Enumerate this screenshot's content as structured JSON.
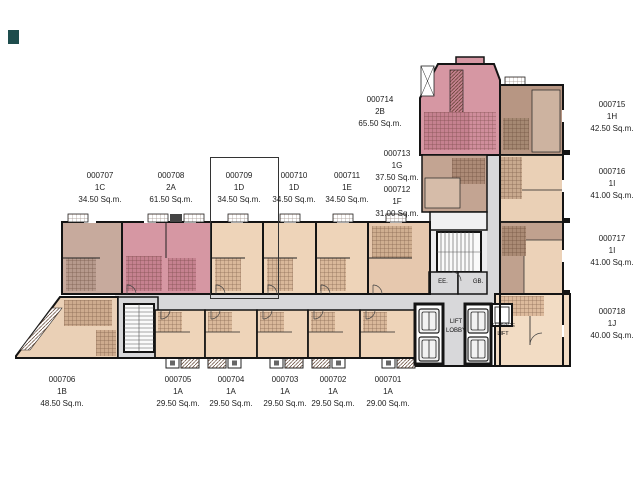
{
  "selection": {
    "selected_unit": "000709"
  },
  "units": [
    {
      "number": "000707",
      "type": "1C",
      "area": "34.50 Sq.m."
    },
    {
      "number": "000708",
      "type": "2A",
      "area": "61.50 Sq.m."
    },
    {
      "number": "000709",
      "type": "1D",
      "area": "34.50 Sq.m."
    },
    {
      "number": "000710",
      "type": "1D",
      "area": "34.50 Sq.m."
    },
    {
      "number": "000711",
      "type": "1E",
      "area": "34.50 Sq.m."
    },
    {
      "number": "000712",
      "type": "1F",
      "area": "31.00 Sq.m."
    },
    {
      "number": "000713",
      "type": "1G",
      "area": "37.50 Sq.m."
    },
    {
      "number": "000714",
      "type": "2B",
      "area": "65.50 Sq.m."
    },
    {
      "number": "000715",
      "type": "1H",
      "area": "42.50 Sq.m."
    },
    {
      "number": "000716",
      "type": "1I",
      "area": "41.00 Sq.m."
    },
    {
      "number": "000717",
      "type": "1I",
      "area": "41.00 Sq.m."
    },
    {
      "number": "000718",
      "type": "1J",
      "area": "40.00 Sq.m."
    },
    {
      "number": "000701",
      "type": "1A",
      "area": "29.00 Sq.m."
    },
    {
      "number": "000702",
      "type": "1A",
      "area": "29.50 Sq.m."
    },
    {
      "number": "000703",
      "type": "1A",
      "area": "29.50 Sq.m."
    },
    {
      "number": "000704",
      "type": "1A",
      "area": "29.50 Sq.m."
    },
    {
      "number": "000705",
      "type": "1A",
      "area": "29.50 Sq.m."
    },
    {
      "number": "000706",
      "type": "1B",
      "area": "48.50 Sq.m."
    }
  ],
  "core_labels": {
    "lift_line1": "LIFT",
    "lift_line2": "LOBBY",
    "service_line1": "SERVICE",
    "service_line2": "LIFT",
    "ee": "EE.",
    "gb": "GB."
  },
  "palette": {
    "pink": "#d697a3",
    "mauve": "#c7aa9d",
    "peach": "#eed4b9",
    "brown": "#b79683",
    "cream": "#f2dcc4",
    "corridor": "#d8d8da",
    "wall": "#141414",
    "highlight_border": "#333333",
    "watermark": "#1e4d4d"
  }
}
